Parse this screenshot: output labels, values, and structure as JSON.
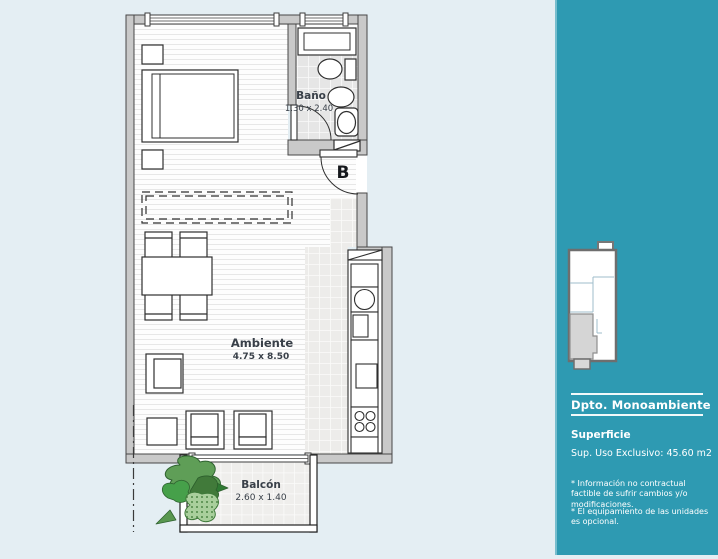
{
  "colors": {
    "sidebar_bg": "#2E9AB2",
    "plan_bg": "#E4EEF3",
    "wall_gray": "#C9C9C9",
    "plant_green": "#5F9E57"
  },
  "plan": {
    "labels": {
      "bathroom": {
        "name": "Baño",
        "dims": "1.30 x 2.40"
      },
      "main": {
        "name": "Ambiente",
        "dims": "4.75 x 8.50"
      },
      "balcony": {
        "name": "Balcón",
        "dims": "2.60 x 1.40"
      },
      "entry_door": "B"
    }
  },
  "sidebar": {
    "title": "Dpto. Monoambiente",
    "section_heading": "Superficie",
    "surface_line": "Sup. Uso Exclusivo: 45.60 m2",
    "footnotes": [
      "* Información no contractual factible de sufrir cambios y/o modificaciones.",
      "* El equipamiento de las unidades es opcional."
    ]
  }
}
